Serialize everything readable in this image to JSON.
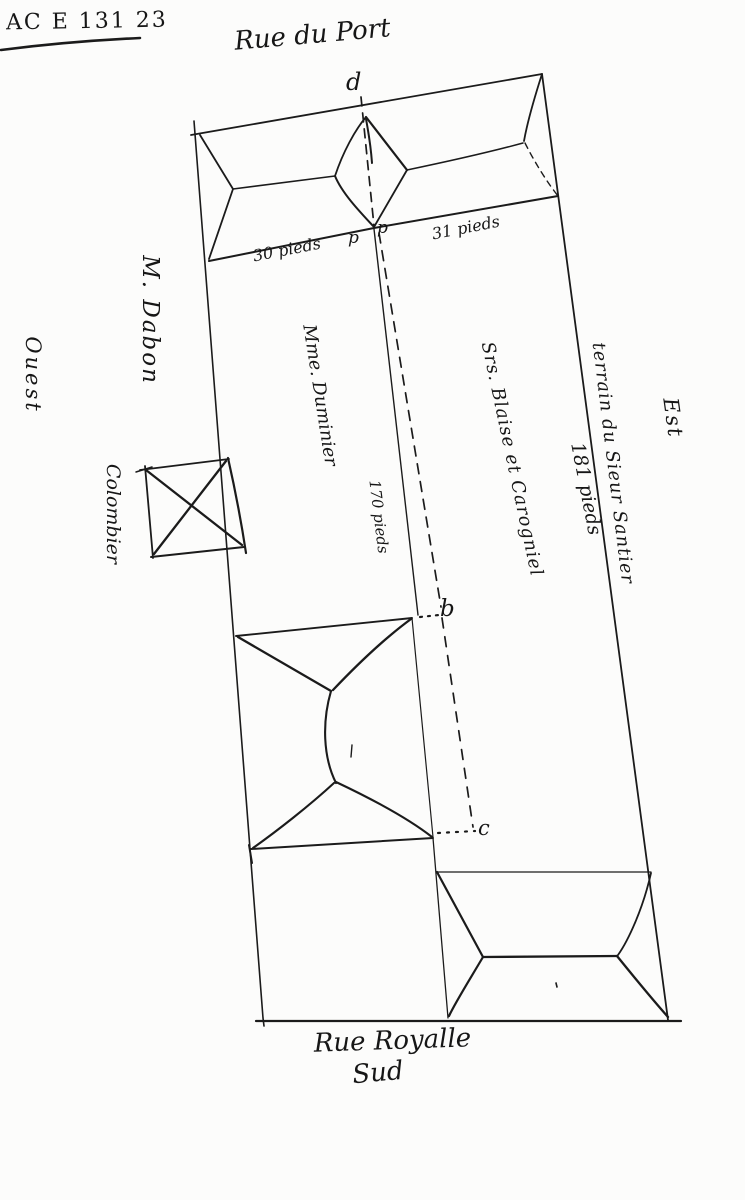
{
  "meta": {
    "archive_ref": "AC E 131 23"
  },
  "streets": {
    "top": "Rue du Port",
    "bottom": "Rue Royalle",
    "bottom_sub": "Sud"
  },
  "directions": {
    "east": "Est",
    "west": "Ouest"
  },
  "owners": {
    "west_neighbor": "M. Dabon",
    "inner_left": "Mme. Duminier",
    "inner_right": "Srs. Blaise et Carogniel",
    "east_terrain": "terrain du Sieur Santier"
  },
  "features": {
    "dovecote": "Colombier"
  },
  "measurements": {
    "front_left": "30 pieds",
    "front_right": "31 pieds",
    "depth_inner": "170 pieds",
    "depth_east": "181 pieds"
  },
  "points": {
    "d": "d",
    "p1": "p",
    "p2": "p",
    "b": "b",
    "c": "c"
  }
}
